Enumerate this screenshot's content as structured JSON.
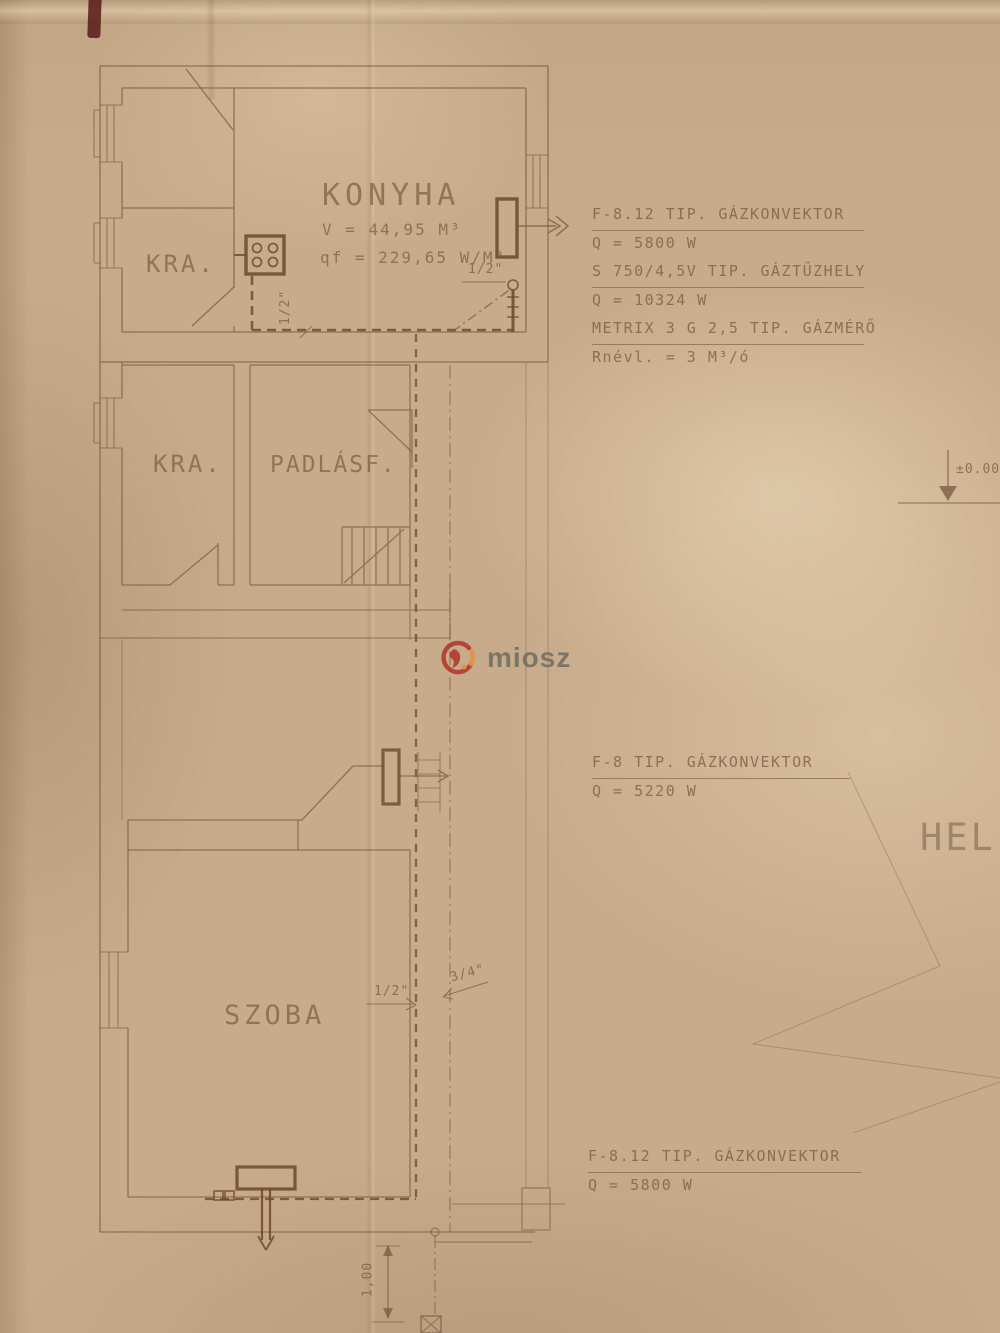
{
  "rooms": {
    "konyha": {
      "name": "KONYHA",
      "volume": "V = 44,95 M³",
      "specific_heat": "qf = 229,65 W/M³"
    },
    "kra_top": {
      "name": "KRA."
    },
    "kra_mid": {
      "name": "KRA."
    },
    "padlasf": {
      "name": "PADLÁSF."
    },
    "szoba": {
      "name": "SZOBA"
    }
  },
  "annotations": {
    "kitchen_equipment": {
      "line1": "F-8.12 TIP. GÁZKONVEKTOR",
      "line2": "Q = 5800 W",
      "line3": "S 750/4,5V TIP. GÁZTŰZHELY",
      "line4": "Q = 10324 W",
      "line5": "METRIX 3 G 2,5 TIP. GÁZMÉRŐ",
      "line6": "Rnévl. = 3 M³/ó"
    },
    "upper_convector": {
      "line1": "F-8 TIP. GÁZKONVEKTOR",
      "line2": "Q = 5220 W"
    },
    "lower_convector": {
      "line1": "F-8.12 TIP. GÁZKONVEKTOR",
      "line2": "Q = 5800 W"
    }
  },
  "pipe_labels": {
    "kitchen_vertical": "1/2\"",
    "kitchen_riser": "1/2\"",
    "szoba_riser": "1/2\"",
    "main_riser": "3/4\""
  },
  "markers": {
    "level": "±0.00",
    "dimension": "1,00",
    "site_plan_partial": "HEL"
  },
  "watermark": {
    "text": "miosz"
  },
  "colors": {
    "paper": "#c7ab8b",
    "ink": "#7c5f45",
    "watermark_red": "#b23327",
    "watermark_orange": "#e2913f",
    "watermark_gray": "#6d6d63"
  }
}
